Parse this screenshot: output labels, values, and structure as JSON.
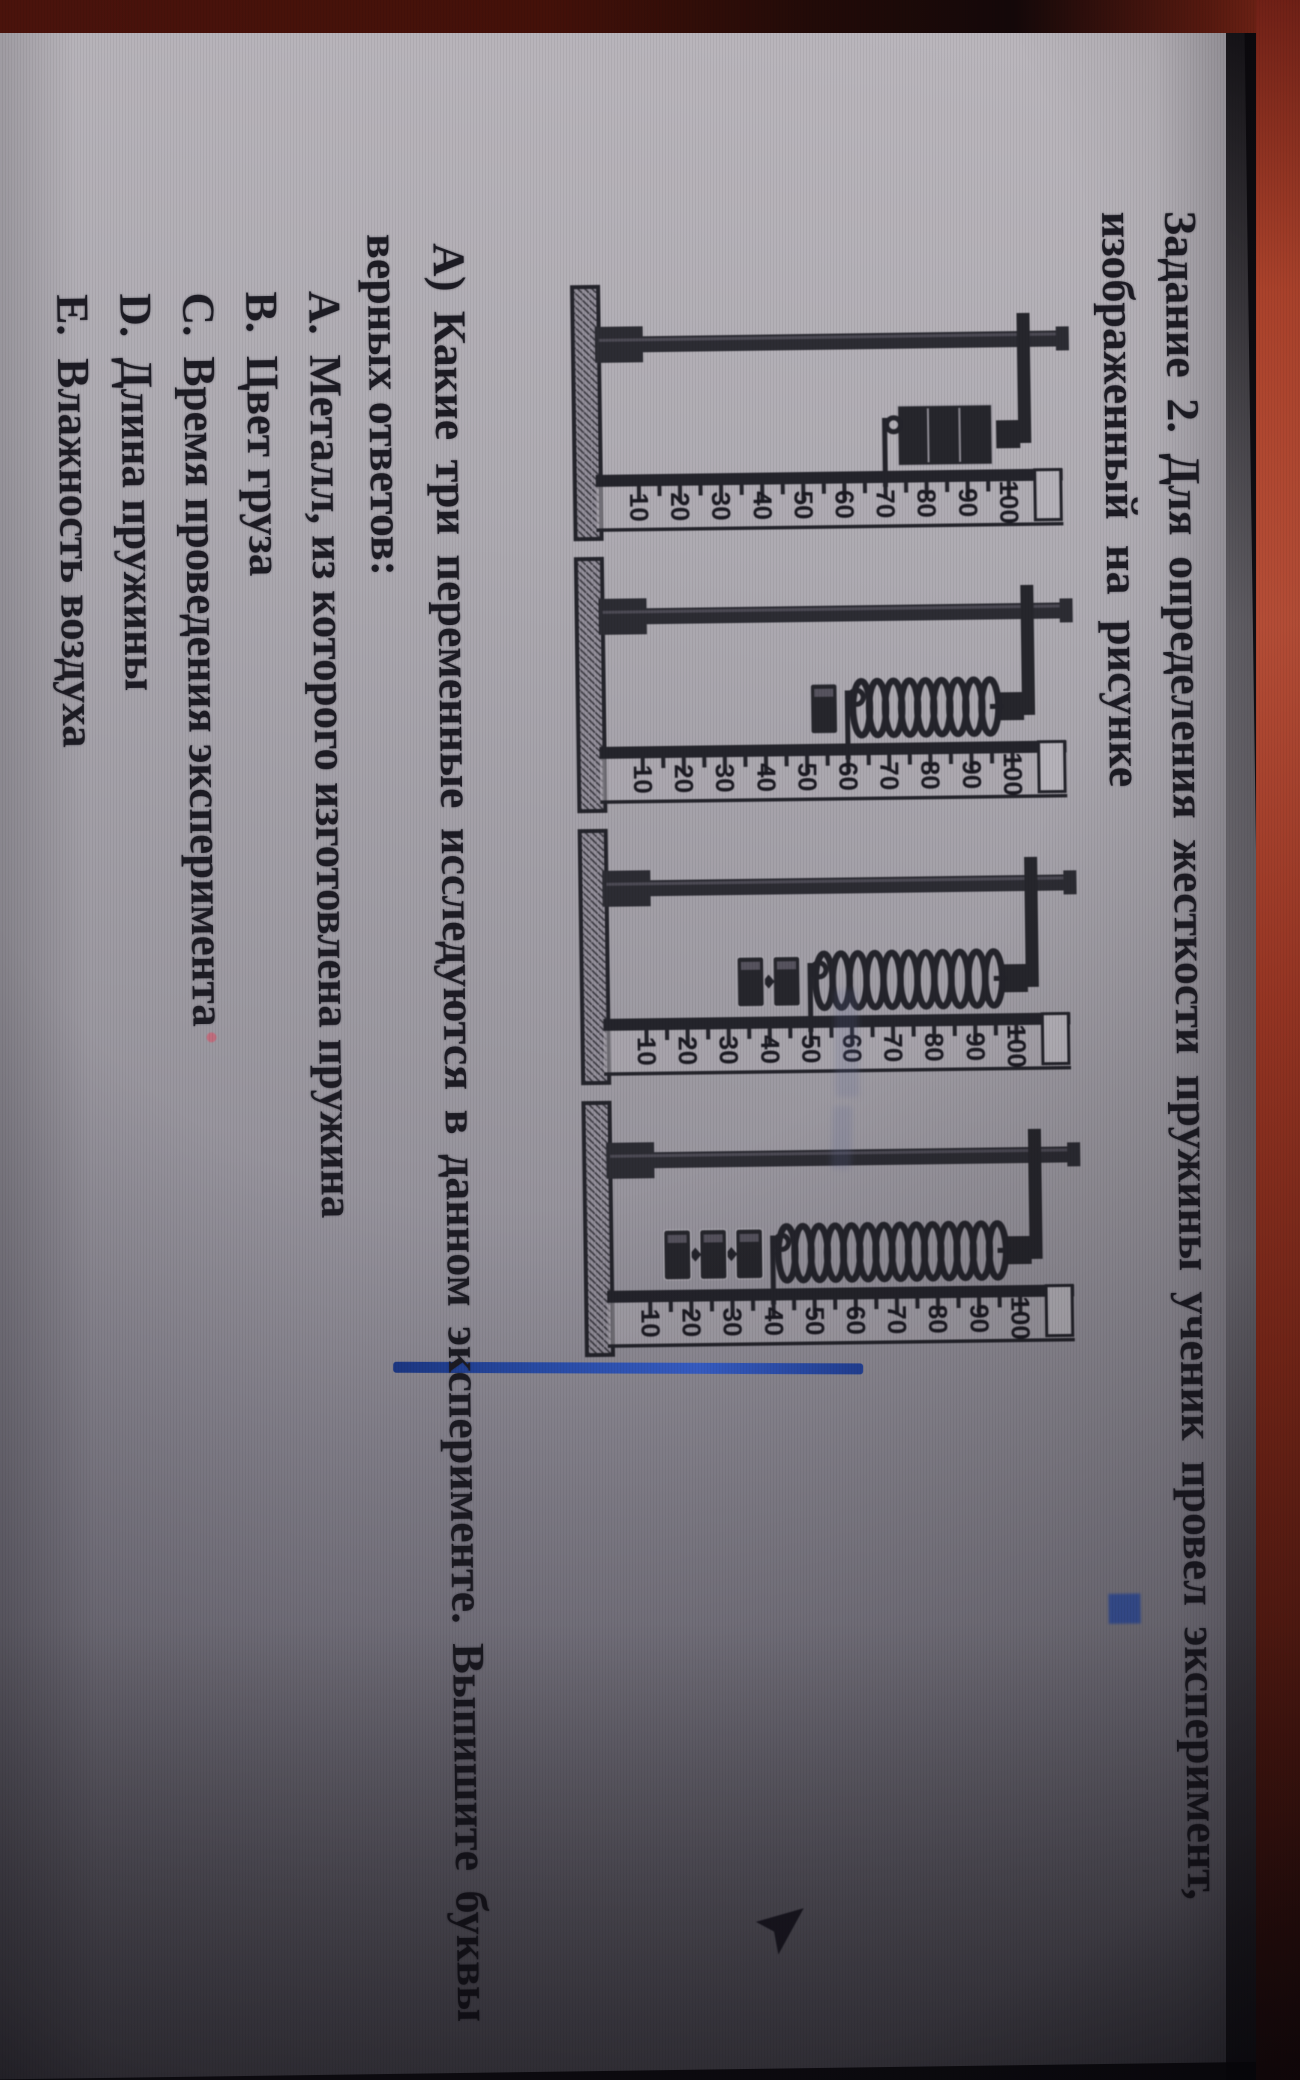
{
  "header": {
    "line1": "Задание 2. Для определения жесткости пружины ученик  провел эксперимент,",
    "line2": "изображенный на рисунке"
  },
  "question": {
    "line1": "А) Какие три переменные исследуются в  данном эксперименте. Выпишите буквы",
    "line2": "верных ответов:"
  },
  "options": [
    {
      "marker": "А.",
      "text": "Металл, из которого изготовлена пружина"
    },
    {
      "marker": "В.",
      "text": "Цвет груза"
    },
    {
      "marker": "С.",
      "text": "Время проведения эксперимента"
    },
    {
      "marker": "D.",
      "text": "Длина пружины"
    },
    {
      "marker": "Е.",
      "text": "Влажность воздуха"
    }
  ],
  "figure": {
    "description": "four retort stands with a spring on a ruler scale",
    "ruler_numbers": [
      "10",
      "20",
      "30",
      "40",
      "50",
      "60",
      "70",
      "80",
      "90",
      "100"
    ],
    "scale_range": [
      10,
      100
    ],
    "stands": [
      {
        "name": "stand-1",
        "weights": 0,
        "spring_compact": true,
        "pointer_value": 70
      },
      {
        "name": "stand-2",
        "weights": 1,
        "spring_compact": false,
        "pointer_value": 60
      },
      {
        "name": "stand-3",
        "weights": 2,
        "spring_compact": false,
        "pointer_value": 50
      },
      {
        "name": "stand-4",
        "weights": 3,
        "spring_compact": false,
        "pointer_value": 40
      }
    ]
  },
  "colors": {
    "ink": "#24242b",
    "page_light": "#bab6bc",
    "page_dark": "#716e7a",
    "bezel_red": "#c3533a",
    "blue_line": "#2a4fae"
  }
}
